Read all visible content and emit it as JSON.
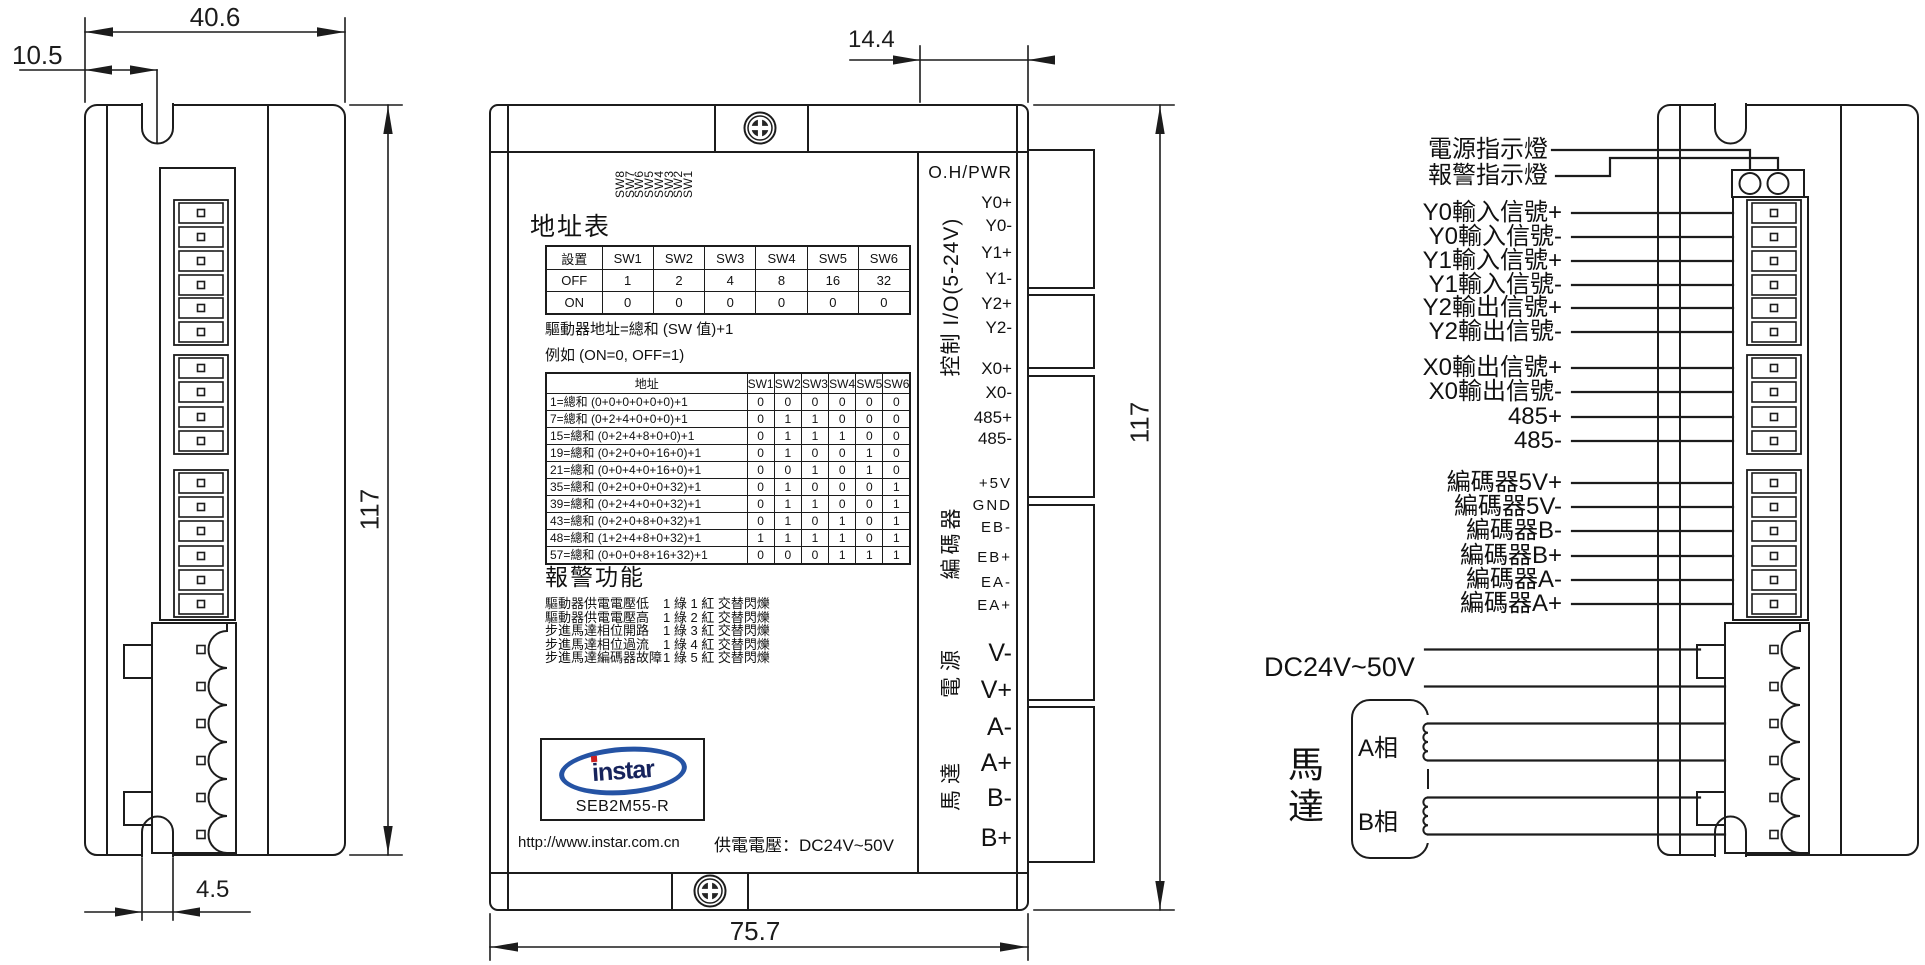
{
  "colors": {
    "line": "#1c1c1c",
    "logo_oval": "#2553a4",
    "logo_text": "#16235c",
    "logo_dot": "#cc2020"
  },
  "dimensions": {
    "left_width": "40.6",
    "left_notch_offset": "10.5",
    "left_height": "117",
    "left_notch_width": "4.5",
    "mid_flange": "14.4",
    "mid_height": "117",
    "mid_width": "75.7"
  },
  "middle_view": {
    "top_label": "O.H/PWR",
    "dip": [
      "SW8",
      "SW7",
      "SW6",
      "SW5",
      "SW4",
      "SW3",
      "SW2",
      "SW1"
    ],
    "addr_title": "地址表",
    "sw_table": {
      "headers": [
        "設置",
        "SW1",
        "SW2",
        "SW3",
        "SW4",
        "SW5",
        "SW6"
      ],
      "rows": [
        [
          "OFF",
          "1",
          "2",
          "4",
          "8",
          "16",
          "32"
        ],
        [
          "ON",
          "0",
          "0",
          "0",
          "0",
          "0",
          "0"
        ]
      ]
    },
    "formula": "驅動器地址=總和 (SW 值)+1",
    "example": "例如 (ON=0, OFF=1)",
    "addr_table": {
      "headers": [
        "地址",
        "SW1",
        "SW2",
        "SW3",
        "SW4",
        "SW5",
        "SW6"
      ],
      "rows": [
        [
          "1=總和 (0+0+0+0+0+0)+1",
          "0",
          "0",
          "0",
          "0",
          "0",
          "0"
        ],
        [
          "7=總和 (0+2+4+0+0+0)+1",
          "0",
          "1",
          "1",
          "0",
          "0",
          "0"
        ],
        [
          "15=總和 (0+2+4+8+0+0)+1",
          "0",
          "1",
          "1",
          "1",
          "0",
          "0"
        ],
        [
          "19=總和 (0+2+0+0+16+0)+1",
          "0",
          "1",
          "0",
          "0",
          "1",
          "0"
        ],
        [
          "21=總和 (0+0+4+0+16+0)+1",
          "0",
          "0",
          "1",
          "0",
          "1",
          "0"
        ],
        [
          "35=總和 (0+2+0+0+0+32)+1",
          "0",
          "1",
          "0",
          "0",
          "0",
          "1"
        ],
        [
          "39=總和 (0+2+4+0+0+32)+1",
          "0",
          "1",
          "1",
          "0",
          "0",
          "1"
        ],
        [
          "43=總和 (0+2+0+8+0+32)+1",
          "0",
          "1",
          "0",
          "1",
          "0",
          "1"
        ],
        [
          "48=總和 (1+2+4+8+0+32)+1",
          "1",
          "1",
          "1",
          "1",
          "0",
          "1"
        ],
        [
          "57=總和 (0+0+0+8+16+32)+1",
          "0",
          "0",
          "0",
          "1",
          "1",
          "1"
        ]
      ]
    },
    "alarm_title": "報警功能",
    "alarms": [
      {
        "fault": "驅動器供電電壓低",
        "code": "1 綠 1 紅  交替閃爍"
      },
      {
        "fault": "驅動器供電電壓高",
        "code": "1 綠 2 紅  交替閃爍"
      },
      {
        "fault": "步進馬達相位開路",
        "code": "1 綠 3 紅  交替閃爍"
      },
      {
        "fault": "步進馬達相位過流",
        "code": "1 綠 4 紅  交替閃爍"
      },
      {
        "fault": "步進馬達編碼器故障",
        "code": "1 綠 5 紅  交替閃爍"
      }
    ],
    "group_labels": [
      "控制 I/O(5-24V)",
      "編碼器",
      "電源",
      "馬達"
    ],
    "terminals": [
      "Y0+",
      "Y0-",
      "Y1+",
      "Y1-",
      "Y2+",
      "Y2-",
      "X0+",
      "X0-",
      "485+",
      "485-",
      "+5V",
      "GND",
      "EB-",
      "EB+",
      "EA-",
      "EA+",
      "V-",
      "V+",
      "A-",
      "A+",
      "B-",
      "B+"
    ],
    "logo": {
      "name": "instar",
      "model": "SEB2M55-R"
    },
    "url": "http://www.instar.com.cn",
    "supply": "供電電壓：DC24V~50V"
  },
  "right_view": {
    "wire_labels": [
      "電源指示燈",
      "報警指示燈",
      "Y0輸入信號+",
      "Y0輸入信號-",
      "Y1輸入信號+",
      "Y1輸入信號-",
      "Y2輸出信號+",
      "Y2輸出信號-",
      "X0輸出信號+",
      "X0輸出信號-",
      "485+",
      "485-",
      "編碼器5V+",
      "編碼器5V-",
      "編碼器B-",
      "編碼器B+",
      "編碼器A-",
      "編碼器A+"
    ],
    "dc_label": "DC24V~50V",
    "motor_label": "馬達",
    "phases": [
      "A相",
      "B相"
    ]
  }
}
